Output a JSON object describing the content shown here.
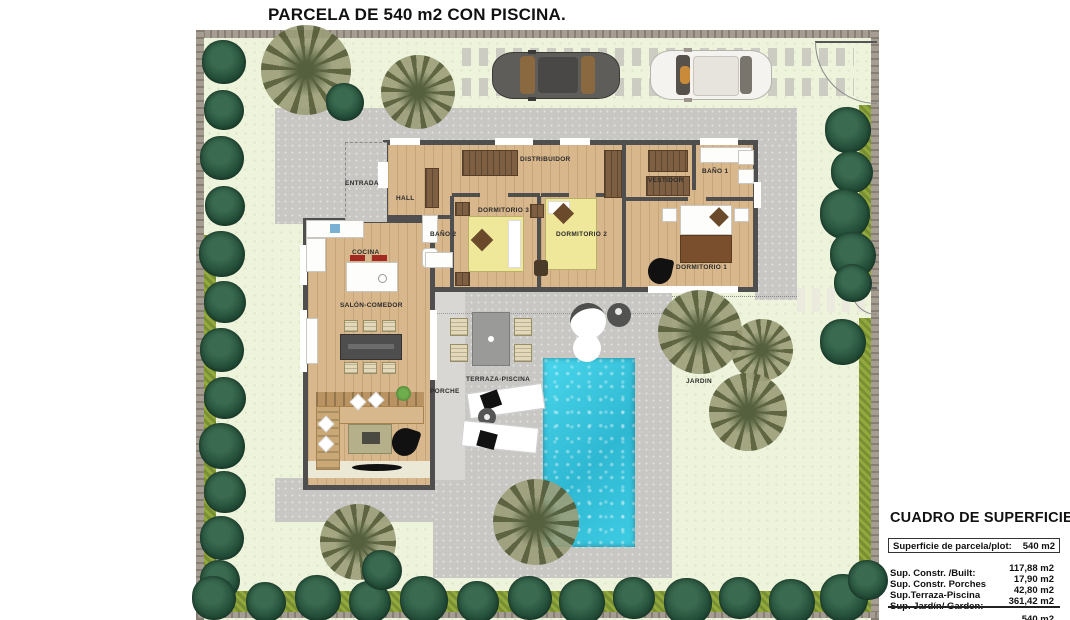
{
  "title": "PARCELA DE 540 m2 CON PISCINA.",
  "rooms": {
    "entrada": "ENTRADA",
    "hall": "HALL",
    "distribuidor": "DISTRIBUIDOR",
    "dormitorio_3": "DORMITORIO 3",
    "bano_2": "BAÑO 2",
    "dormitorio_2": "DORMITORIO 2",
    "vestidor": "VESTIDOR",
    "bano_1": "BAÑO 1",
    "dormitorio_1": "DORMITORIO 1",
    "cocina": "COCINA",
    "salon_comedor": "SALÓN-COMEDOR",
    "terraza_piscina": "TERRAZA-PISCINA",
    "porche": "PORCHE",
    "jardin": "JARDIN"
  },
  "summary": {
    "title": "CUADRO DE SUPERFICIES",
    "plot_label": "Superficie de parcela/plot:",
    "plot_value": "540 m2",
    "rows": [
      {
        "label": "Sup. Constr. /Built:",
        "value": "117,88 m2"
      },
      {
        "label": "Sup. Constr. Porches",
        "value": "17,90 m2"
      },
      {
        "label": "Sup.Terraza-Piscina",
        "value": "42,80 m2"
      },
      {
        "label": "Sup. Jardín/ Garden:",
        "value": "361,42 m2"
      }
    ],
    "total_value": "540 m2"
  },
  "colors": {
    "pool_water": "#35c3db",
    "garden_green": "#eef4db",
    "paving_gray": "#c8c7c4",
    "wood_floor": "#d8b78c",
    "house_wall": "#4f4f4f",
    "hedge_olive": "#93a83d",
    "tree_green": "#234d38",
    "boundary_wall": "#a59d92",
    "car_dark": "#5f5d5a",
    "car_white": "#f4f3f0"
  }
}
